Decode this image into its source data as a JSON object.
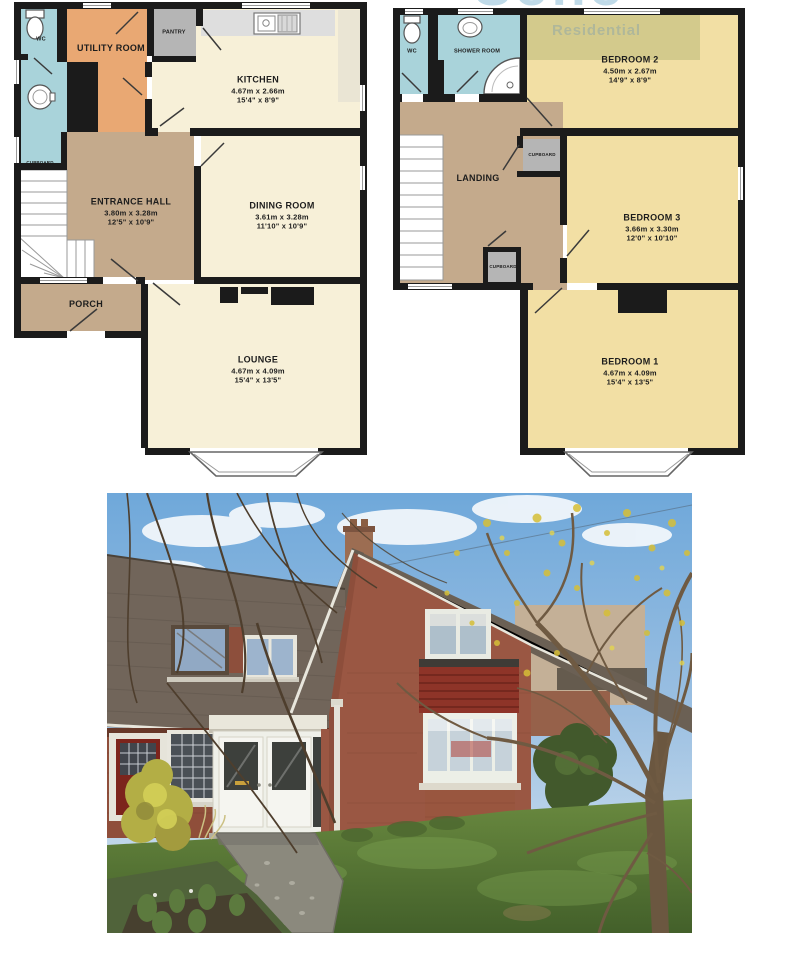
{
  "watermark": {
    "brand": "Soho",
    "sub": "Residential"
  },
  "floorplans": {
    "ground": {
      "rooms": [
        {
          "id": "wc",
          "label": "WC"
        },
        {
          "id": "utility-room",
          "label": "UTILITY ROOM"
        },
        {
          "id": "pantry",
          "label": "PANTRY"
        },
        {
          "id": "kitchen",
          "label": "KITCHEN",
          "dims_m": "4.67m x 2.66m",
          "dims_ft": "15'4\" x 8'9\""
        },
        {
          "id": "cupboard",
          "label": "CUPBOARD"
        },
        {
          "id": "entrance-hall",
          "label": "ENTRANCE HALL",
          "dims_m": "3.80m x 3.28m",
          "dims_ft": "12'5\" x 10'9\""
        },
        {
          "id": "dining-room",
          "label": "DINING ROOM",
          "dims_m": "3.61m x 3.28m",
          "dims_ft": "11'10\" x 10'9\""
        },
        {
          "id": "porch",
          "label": "PORCH"
        },
        {
          "id": "lounge",
          "label": "LOUNGE",
          "dims_m": "4.67m x 4.09m",
          "dims_ft": "15'4\" x 13'5\""
        }
      ]
    },
    "first": {
      "rooms": [
        {
          "id": "wc",
          "label": "WC"
        },
        {
          "id": "shower-room",
          "label": "SHOWER ROOM"
        },
        {
          "id": "bedroom-2",
          "label": "BEDROOM 2",
          "dims_m": "4.50m x 2.67m",
          "dims_ft": "14'9\" x 8'9\""
        },
        {
          "id": "landing",
          "label": "LANDING"
        },
        {
          "id": "cupboard-top",
          "label": "CUPBOARD"
        },
        {
          "id": "bedroom-3",
          "label": "BEDROOM 3",
          "dims_m": "3.66m x 3.30m",
          "dims_ft": "12'0\" x 10'10\""
        },
        {
          "id": "cupboard-bottom",
          "label": "CUPBOARD"
        },
        {
          "id": "bedroom-1",
          "label": "BEDROOM 1",
          "dims_m": "4.67m x 4.09m",
          "dims_ft": "15'4\" x 13'5\""
        }
      ]
    },
    "colors": {
      "wall": "#1b1b1b",
      "cream_room": "#f7f0d8",
      "yellow_room": "#f2dfa4",
      "tan_room": "#c4aa8c",
      "orange_room": "#e9a873",
      "blue_room": "#a9d3da",
      "grey_room": "#b5b5b5",
      "worktop": "#dedede"
    }
  },
  "photo": {
    "colors": {
      "sky": "#6fa8da",
      "roof": "#6b6054",
      "brick": "#9a5743",
      "tile_panel": "#8e3428",
      "joinery_white": "#eff0e9",
      "front_door_red": "#7c241c",
      "lawn": "#5e8040",
      "path": "#8b897d",
      "foliage_yellow": "#d6bf37",
      "bush_green": "#42592c"
    }
  }
}
